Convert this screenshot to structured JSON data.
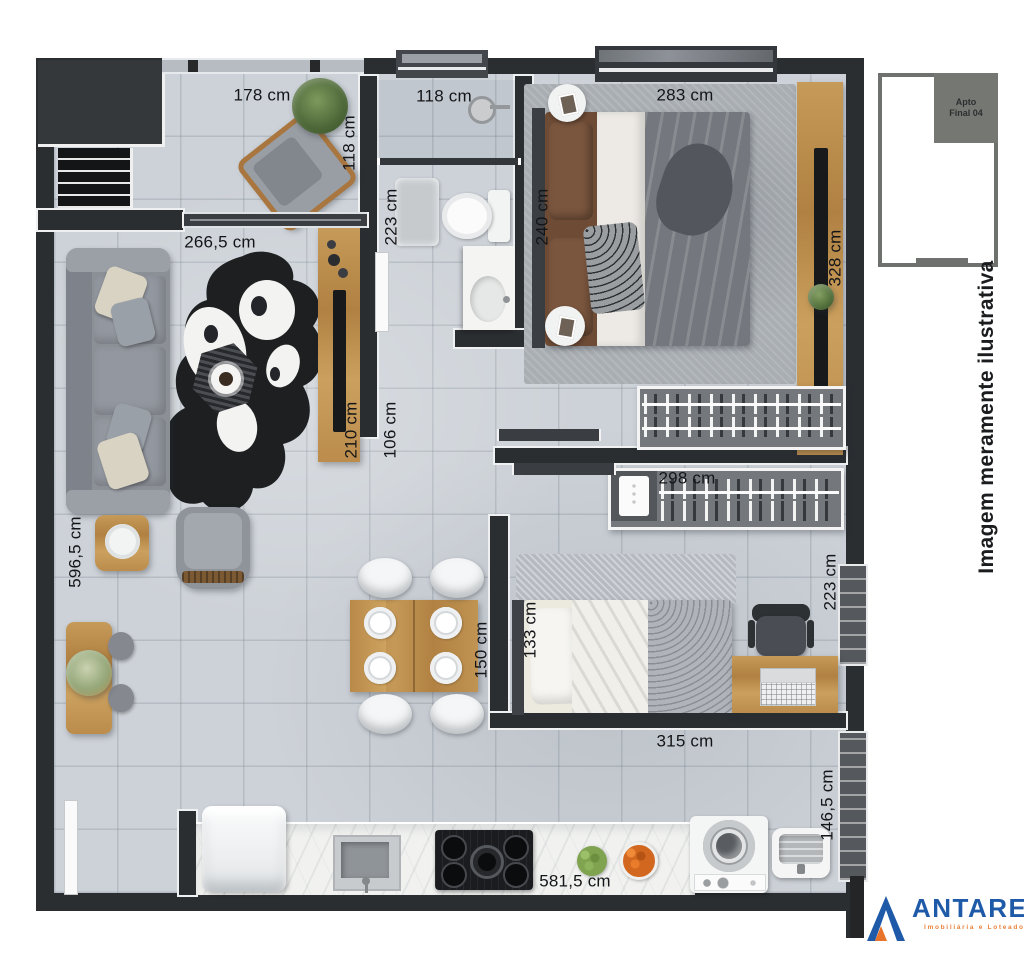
{
  "page": {
    "disclaimer": "Imagem meramente ilustrativa"
  },
  "keyplan": {
    "unit_line1": "Apto",
    "unit_line2": "Final 04"
  },
  "brand": {
    "name": "ANTARES",
    "tagline": "Imobiliária e Loteadora",
    "blue": "#1f5aa8",
    "orange": "#e8813b"
  },
  "labels": {
    "balcony_width": "178 cm",
    "balcony_depth": "118 cm",
    "bath_width": "118 cm",
    "bath_depth": "223 cm",
    "balcony_door_width": "266,5 cm",
    "bedroom1_width": "283 cm",
    "bedroom1_depth": "240 cm",
    "bedroom1_side": "328 cm",
    "tv_panel_length": "210 cm",
    "passage_width": "106 cm",
    "hall_width": "298 cm",
    "living_depth": "596,5 cm",
    "bedroom2_bed_width": "133 cm",
    "bedroom2_depth": "223 cm",
    "dining_table_width": "150 cm",
    "bedroom2_width": "315 cm",
    "laundry_depth": "146,5 cm",
    "kitchen_run_length": "581,5 cm"
  }
}
